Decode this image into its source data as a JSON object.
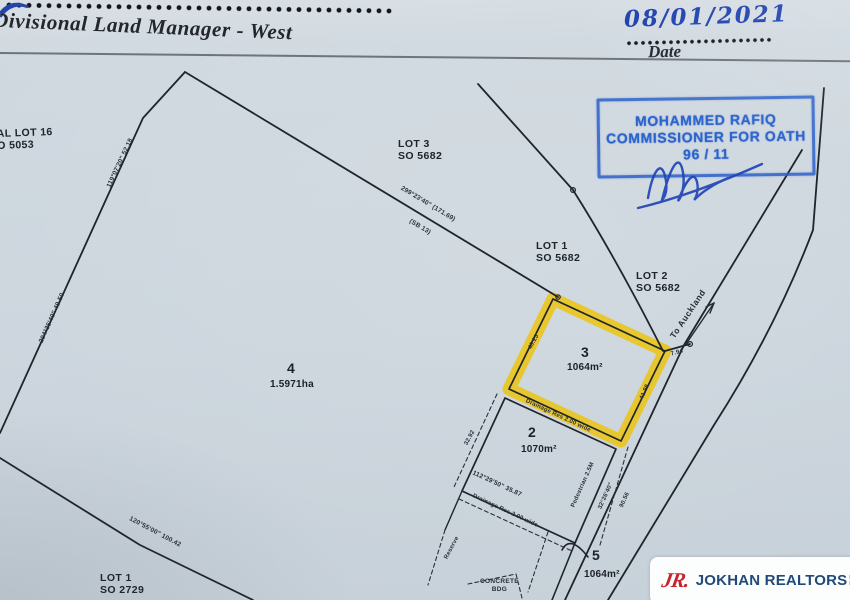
{
  "colors": {
    "paper": "#ccd5dd",
    "ink": "#20242b",
    "stamp_blue": "#2b63cd",
    "pen_blue": "#1d3fae",
    "highlight_yellow": "#e9c51f",
    "logo_red": "#c8242e",
    "logo_blue": "#224a78"
  },
  "header": {
    "signature_title": "Divisional Land Manager - West",
    "date_value": "08/01/2021",
    "date_label": "Date"
  },
  "stamp": {
    "line1": "MOHAMMED RAFIQ",
    "line2": "COMMISSIONER FOR OATH",
    "line3": "96 / 11"
  },
  "plan": {
    "lot_labels": [
      {
        "line1": "LOT 3",
        "line2": "SO 5682"
      },
      {
        "line1": "LOT 1",
        "line2": "SO 5682"
      },
      {
        "line1": "LOT 2",
        "line2": "SO 5682"
      },
      {
        "line1": "LOT 1",
        "line2": "SO 2729"
      },
      {
        "line1": "AL LOT 16",
        "line2": "O 5053"
      }
    ],
    "parcels": [
      {
        "number": "4",
        "area": "1.5971ha"
      },
      {
        "number": "3",
        "area": "1064m²",
        "highlighted": true
      },
      {
        "number": "2",
        "area": "1070m²"
      },
      {
        "number": "5",
        "area": "1064m²"
      }
    ],
    "bearings": [
      "119°07'20\"  52.18",
      "204°36'40\"  49.50",
      "299°23'40\"  (171.69)",
      "(SB 13)",
      "120°55'00\"  100.42",
      "112°29'50\"  35.87",
      "Drainage Res  2.00  wide",
      "Drainage Res  2.00  wide",
      "Pedestrian  2.5M",
      "32°26'40\"",
      "90.56",
      "7.94",
      "41.98",
      "40.23",
      "32.92",
      "Reserve"
    ],
    "road_label": "To Auckland",
    "building_line1": "CONCRETE",
    "building_line2": "BDG"
  },
  "logo": {
    "monogram": "JR.",
    "name": "JOKHAN REALTORS",
    "suffix1": "PTE",
    "suffix2": "LTD"
  }
}
